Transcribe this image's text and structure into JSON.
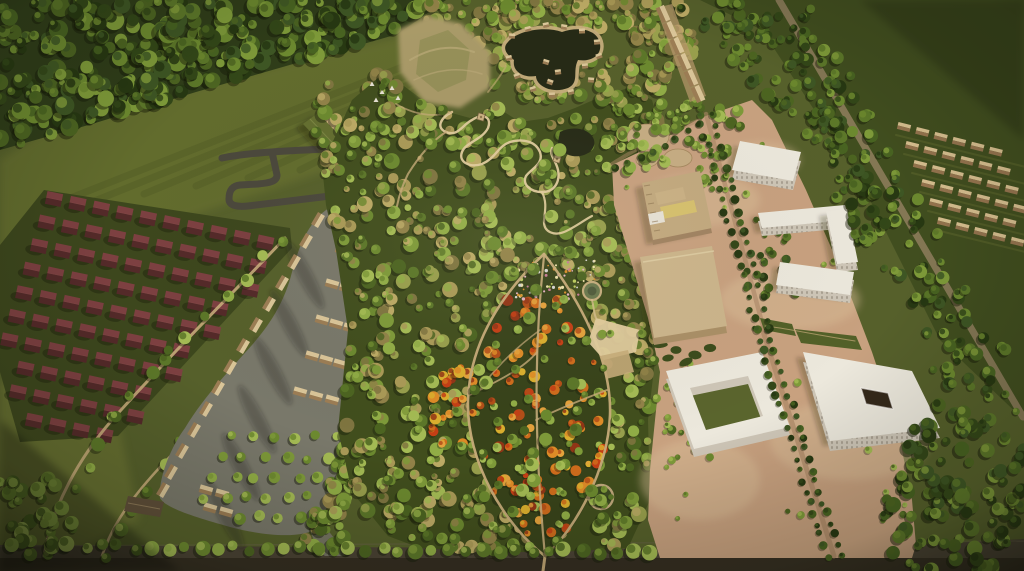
{
  "scene": {
    "type": "aerial-3d-masterplan-render",
    "regions": [
      {
        "name": "top-left-forest-belt"
      },
      {
        "name": "upper-meadow"
      },
      {
        "name": "red-roof-cottage-district"
      },
      {
        "name": "tree-lined-footpaths"
      },
      {
        "name": "resort-village-street"
      },
      {
        "name": "resort-cottages"
      },
      {
        "name": "parking-grove"
      },
      {
        "name": "access-road-loop"
      },
      {
        "name": "green-roof-visitor-building"
      },
      {
        "name": "central-park-forest"
      },
      {
        "name": "serpentine-trail"
      },
      {
        "name": "lookout-towers"
      },
      {
        "name": "bare-hill"
      },
      {
        "name": "glamping-pond-with-cabins"
      },
      {
        "name": "leaf-shaped-autumn-garden"
      },
      {
        "name": "flower-meadow"
      },
      {
        "name": "round-pond"
      },
      {
        "name": "event-circle"
      },
      {
        "name": "campus-sand-ground"
      },
      {
        "name": "circular-pads"
      },
      {
        "name": "factory-building"
      },
      {
        "name": "warehouse-building"
      },
      {
        "name": "white-apartment-slab"
      },
      {
        "name": "white-z-block"
      },
      {
        "name": "white-u-block"
      },
      {
        "name": "white-courtyard-building"
      },
      {
        "name": "tree-lined-avenue"
      },
      {
        "name": "greenhouse-rows"
      },
      {
        "name": "dark-green-field"
      },
      {
        "name": "bottom-perimeter-road"
      }
    ]
  },
  "palette": {
    "meadow_base": "#515d2a",
    "meadow_light": "#63702f",
    "meadow_bright": "#6f7c36",
    "corner_field": "#5a672e",
    "field_dark": "#3a4a1d",
    "forest_dark": "#273817",
    "park_bg": "#3a4a1b",
    "leaf_bg": "#313f18",
    "tree_greens": [
      "#46611f",
      "#577527",
      "#68882e",
      "#7b9a38",
      "#8fae46",
      "#a3bd55"
    ],
    "tree_olive": [
      "#a99a58",
      "#8f8148",
      "#bcab67",
      "#7c7340",
      "#96a04c"
    ],
    "cypress": [
      "#2c4316",
      "#375322",
      "#1f330f",
      "#42601f"
    ],
    "autumn": [
      "#b34a16",
      "#d06a1a",
      "#e08b25",
      "#c53a12",
      "#8f3014",
      "#ddb02d",
      "#e6a33c"
    ],
    "flowers": [
      "#e5b3c6",
      "#efe3ad",
      "#d8d8d8",
      "#dd8f2a",
      "#bcd05e",
      "#c87a9a"
    ],
    "red_roof_lit": "#7a3c41",
    "red_roof_dark": "#4e2428",
    "red_district_bg": "#36431b",
    "cottage_wall": "#cdb285",
    "cottage_roof_lit": "#dcc89c",
    "cottage_roof_dark": "#9a7c55",
    "barn_roof": "#5a4a38",
    "street_asphalt": "#75766c",
    "street_shadow": "#54564c",
    "road_dark": "#45443c",
    "bottom_road": "#443e33",
    "bottom_road_dark": "#28231a",
    "path_tan": "#c8ad7c",
    "path_bright": "#e4d0a2",
    "sand": "#c9a282",
    "sand_light": "#dcc09e",
    "sand_shadow": "#a98565",
    "white_roof": "#efece4",
    "white_face": "#cfc9bd",
    "warehouse_roof": "#cdb78f",
    "warehouse_face": "#a98f68",
    "factory_roof": "#c3ab82",
    "factory_yellow": "#d8c370",
    "water": "#1e2414",
    "pond_ring": "#c6ae80",
    "hill": "#a89a6a",
    "hill_ridge": "#bcac7c",
    "hill_green": "#7d8547",
    "greenhouse_lit": "#d9c193",
    "greenhouse_dark": "#93724f",
    "courtyard_dark": "#2e2318",
    "courtyard_green": "#55622c",
    "green_roof_building": "#5f6d2f"
  }
}
